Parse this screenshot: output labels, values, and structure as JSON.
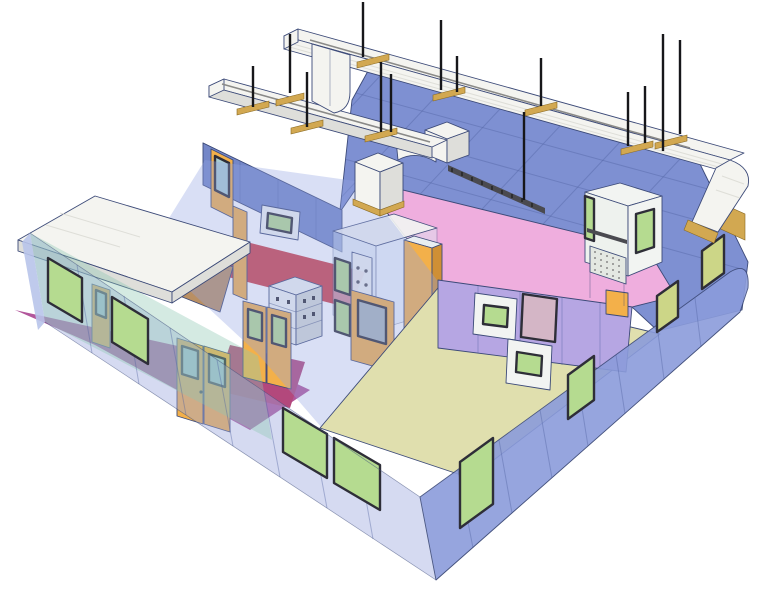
{
  "figure": {
    "kind": "isometric-3d-cutaway-illustration",
    "subject": "modular cleanroom facility with HVAC ductwork"
  },
  "colors": {
    "background": "#ffffff",
    "outline": "#3c4a78",
    "seam": "#50619f",
    "roof_blue": "#7e90d2",
    "wall_blue_deep": "#7487c8",
    "wall_blue": "#9aa8de",
    "pink_deck": "#efaede",
    "lavender_wall": "#b6a6e3",
    "ceiling_tint": "#93a4e2",
    "teal_wall": "#8fc9b4",
    "window_green": "#b5db90",
    "window_yellow": "#ccd687",
    "window_frame": "#2e2e38",
    "door_orange": "#f3b04a",
    "door_orange_dark": "#cf8f35",
    "floor_tan": "#b98f63",
    "floor_beige": "#e0dfae",
    "floor_magenta": "#b2569b",
    "floor_crimson": "#b3487c",
    "floor_red": "#d04048",
    "duct_white": "#f4f4f0",
    "duct_shade": "#dededa",
    "white_equipment": "#f2f4f2",
    "equipment_shade": "#d6dad6",
    "bracket_tan": "#d2a851",
    "rod_black": "#17171a",
    "glass_teal": "#a9cdd3",
    "tray_dark": "#4a4a50"
  },
  "components": [
    {
      "id": "hvac-main-duct",
      "label": "main supply duct"
    },
    {
      "id": "hvac-branch-duct",
      "label": "branch duct"
    },
    {
      "id": "duct-elbow",
      "label": "duct elbow"
    },
    {
      "id": "duct-drop-flange",
      "label": "duct drop with flange"
    },
    {
      "id": "suspension-rods",
      "label": "suspension rods",
      "count": 14
    },
    {
      "id": "duct-hangers",
      "label": "hanger brackets",
      "count": 9
    },
    {
      "id": "ceiling-panels",
      "label": "blue ceiling panels"
    },
    {
      "id": "plenum-deck",
      "label": "pink plenum deck"
    },
    {
      "id": "cable-tray",
      "label": "cable tray"
    },
    {
      "id": "fan-filter-units",
      "label": "fan filter units",
      "count": 2
    },
    {
      "id": "laminar-flow-hood",
      "label": "laminar flow hood"
    },
    {
      "id": "gowning-room",
      "label": "gowning room with white roof"
    },
    {
      "id": "air-shower",
      "label": "air shower chamber"
    },
    {
      "id": "electrical-cabinet",
      "label": "electrical cabinet"
    },
    {
      "id": "storage-cabinet",
      "label": "tall storage cabinet"
    },
    {
      "id": "pass-through-chambers",
      "label": "pass-through chambers",
      "count": 3
    },
    {
      "id": "doors",
      "label": "cleanroom doors",
      "count": 6
    },
    {
      "id": "wall-windows",
      "label": "flush glazed windows",
      "count": 10
    },
    {
      "id": "floor-zones",
      "label": "color-coded floor zones",
      "zones": [
        "magenta-corridor",
        "crimson-zone",
        "red-zone",
        "tan-gowning-floor",
        "beige-cleanroom-floor"
      ]
    }
  ]
}
